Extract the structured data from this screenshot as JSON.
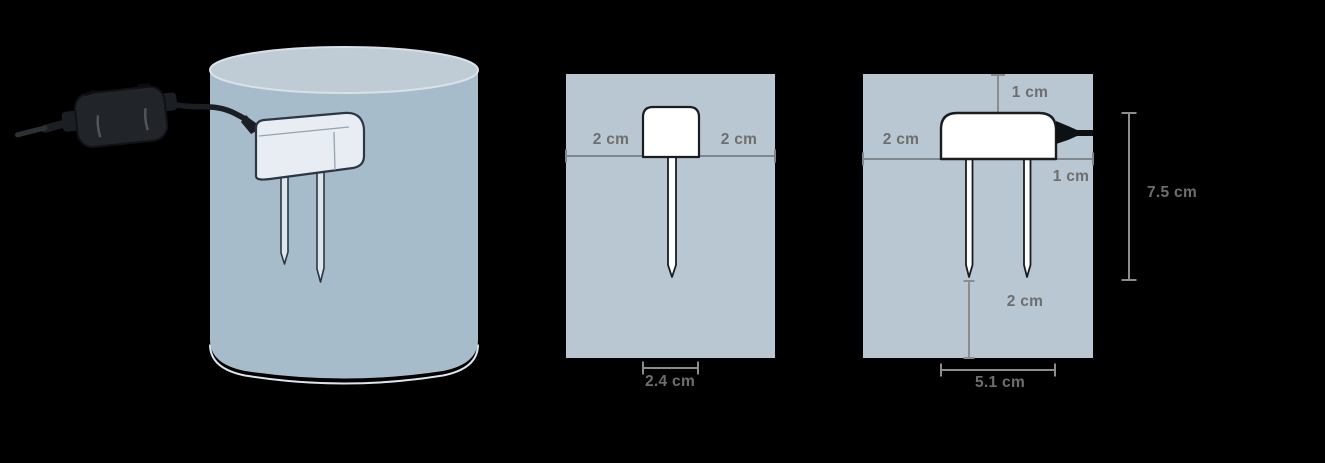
{
  "diagram": {
    "side_view": {
      "label_left": "2 cm",
      "label_right": "2 cm",
      "label_width": "2.4 cm"
    },
    "front_view": {
      "label_top": "1 cm",
      "label_left": "2 cm",
      "label_right": "1 cm",
      "label_height": "7.5 cm",
      "label_tip": "2 cm",
      "label_width": "5.1 cm"
    },
    "colors": {
      "background": "#000000",
      "pot_fill": "#b8c7d2",
      "cylinder_body": "#a7bcca",
      "cylinder_top": "#bfccd6",
      "sensor_fill": "#ffffff",
      "sensor_3d_fill": "#e7edf3",
      "outline": "#1a1d20",
      "dimension_line": "#8c8c8c",
      "soil_line": "#7f888f",
      "label_text": "#6e6e6e",
      "cable": "#1b1f24"
    }
  }
}
